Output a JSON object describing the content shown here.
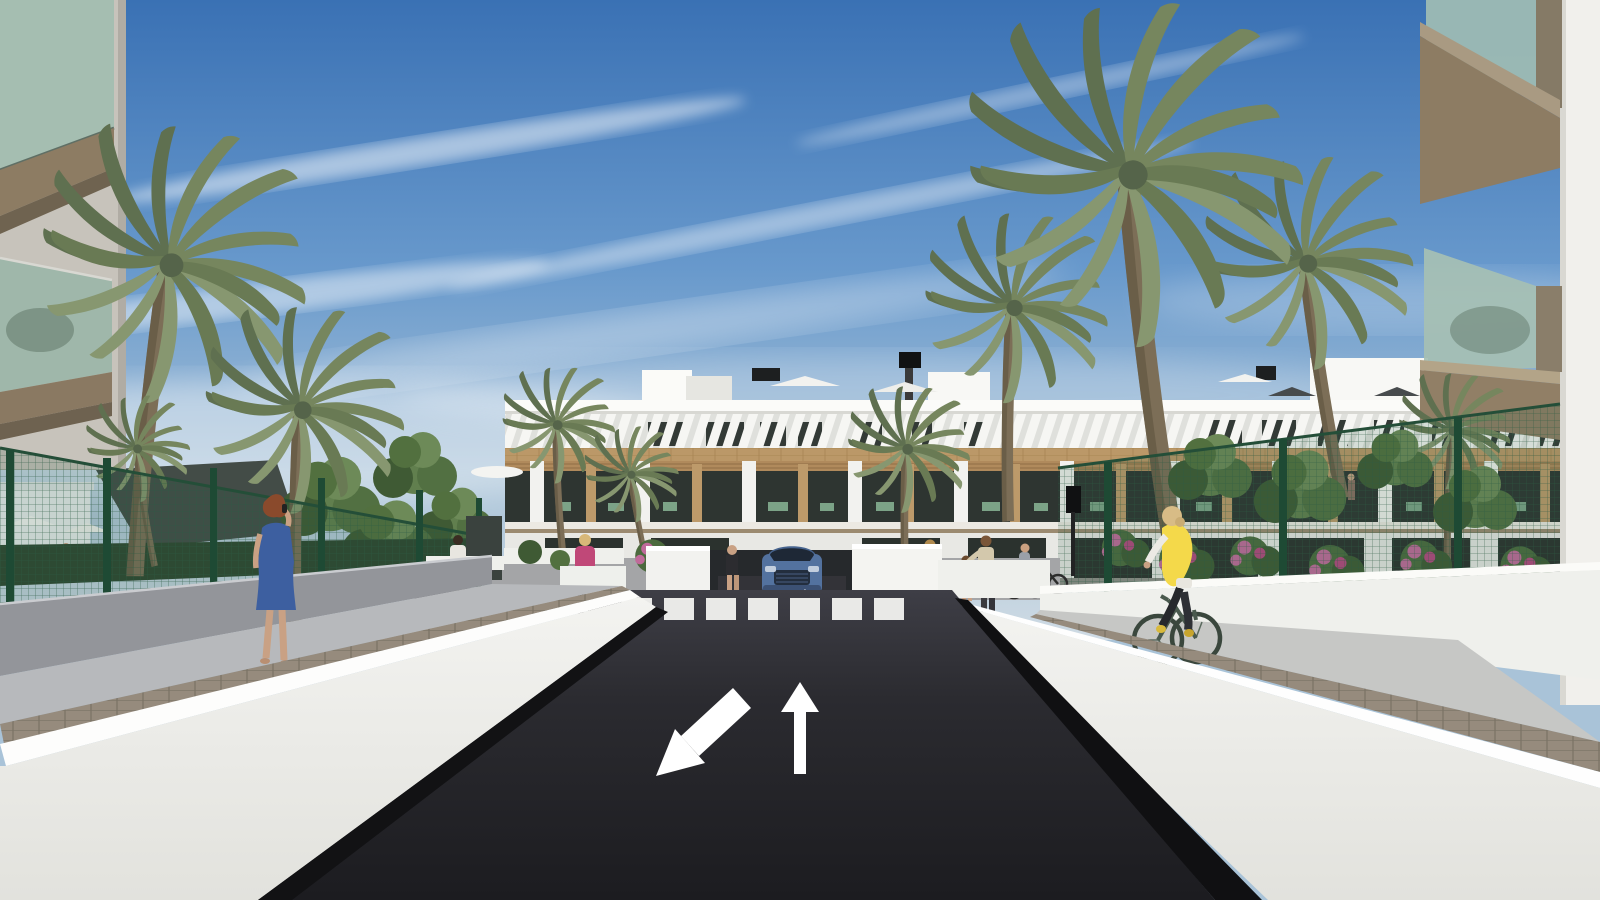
{
  "scene": {
    "description": "3D architectural rendering: street view of a modern white residential complex with palm trees, asphalt access road with painted lane arrows, zebra crosswalk, garage ramp with SUV, pedestrians and a cyclist under a blue sky with wispy clouds",
    "road_markings": {
      "crosswalk_stripe_count": 7,
      "lane_arrow_left_direction": "down-left (towards viewer)",
      "lane_arrow_right_direction": "up (away from viewer)",
      "garage_mini_arrows": [
        "down",
        "up"
      ]
    },
    "vehicles": [
      {
        "type": "suv-front-view",
        "color": "#53729f",
        "location": "center garage ramp"
      }
    ],
    "people": [
      {
        "id": "woman-on-phone",
        "detail": "auburn hair, blue patterned dress, walking on left ramp wall walkway"
      },
      {
        "id": "man-white-tshirt",
        "detail": "walking on dark garden path, mid-left"
      },
      {
        "id": "woman-pink-top",
        "detail": "blonde, dark trousers, tan handbag, mid-left pavement"
      },
      {
        "id": "man-dark-tank",
        "detail": "standing left of garage ramp"
      },
      {
        "id": "woman-with-bicycle",
        "detail": "standing at bike racks right of garage"
      },
      {
        "id": "child",
        "detail": "small child with adult, right pavement"
      },
      {
        "id": "adult-with-child",
        "detail": "reaching toward child, right pavement"
      },
      {
        "id": "cyclist-right",
        "detail": "blonde, yellow vest, white sleeves, dark green bicycle on right path"
      },
      {
        "id": "shirtless-man-pool",
        "detail": "tiny distant figure behind left fence near pool umbrellas"
      }
    ],
    "vegetation": {
      "palm_count": 10,
      "leafy_tree_clusters": 8,
      "flower_colors": [
        "pink",
        "orange"
      ]
    },
    "architecture": {
      "center_building": "3-level white apartment block, white slatted pergola band over top-floor windows, wood-clad band, balconies with timber pergolas and green patio furniture, rooftop terraces with umbrellas and stair bulkheads",
      "foreground_left": "cropped building corner with two green-glass balconies and tan soffits",
      "foreground_right": "cropped white building edge with two green-glass balconies and tan soffits",
      "site": "green mesh fences with posts, white ramp retaining walls, paver sidewalks, dark shade sail over left pool area"
    }
  },
  "palette": {
    "skyTop": "#3a71b4",
    "skyMid": "#6899cc",
    "skyLow": "#a9c3d8",
    "skyHaze": "#cfdbe4",
    "cloud": "#ffffff",
    "palmDark": "#5f7050",
    "palmMid": "#76865e",
    "palmLight": "#879770",
    "trunk": "#7c6e57",
    "trunkDark": "#635741",
    "buildingWhite": "#f5f5f2",
    "buildingShade": "#dfe0dc",
    "woodBand": "#bb9868",
    "woodPergola": "#b08a5c",
    "glassDark": "#2e3531",
    "furnGreen": "#7ca387",
    "fenceGreen": "#2d5c44",
    "leafDark": "#3f5a34",
    "leafMid": "#617f4e",
    "flowerPink": "#c06a9a",
    "flowerOrange": "#c77b3a",
    "road": "#232327",
    "roadFar": "#3e3e46",
    "stripeWhite": "#e9e9e7",
    "wallLit": "#f1f1ee",
    "wallEdge": "#ffffff",
    "grayWall": "#93959a",
    "walkway": "#b7b9bc",
    "paver": "#968b7d",
    "balconyGlass": "#9fbcb4",
    "fasciaTan": "#8d7c63",
    "carBody": "#53729f",
    "skin": "#c9a184",
    "hairAuburn": "#8a4a2c",
    "dressBlue": "#3d5fa0",
    "vestYellow": "#f4d94a",
    "topPink": "#c04878",
    "sailDark": "#434c47"
  }
}
